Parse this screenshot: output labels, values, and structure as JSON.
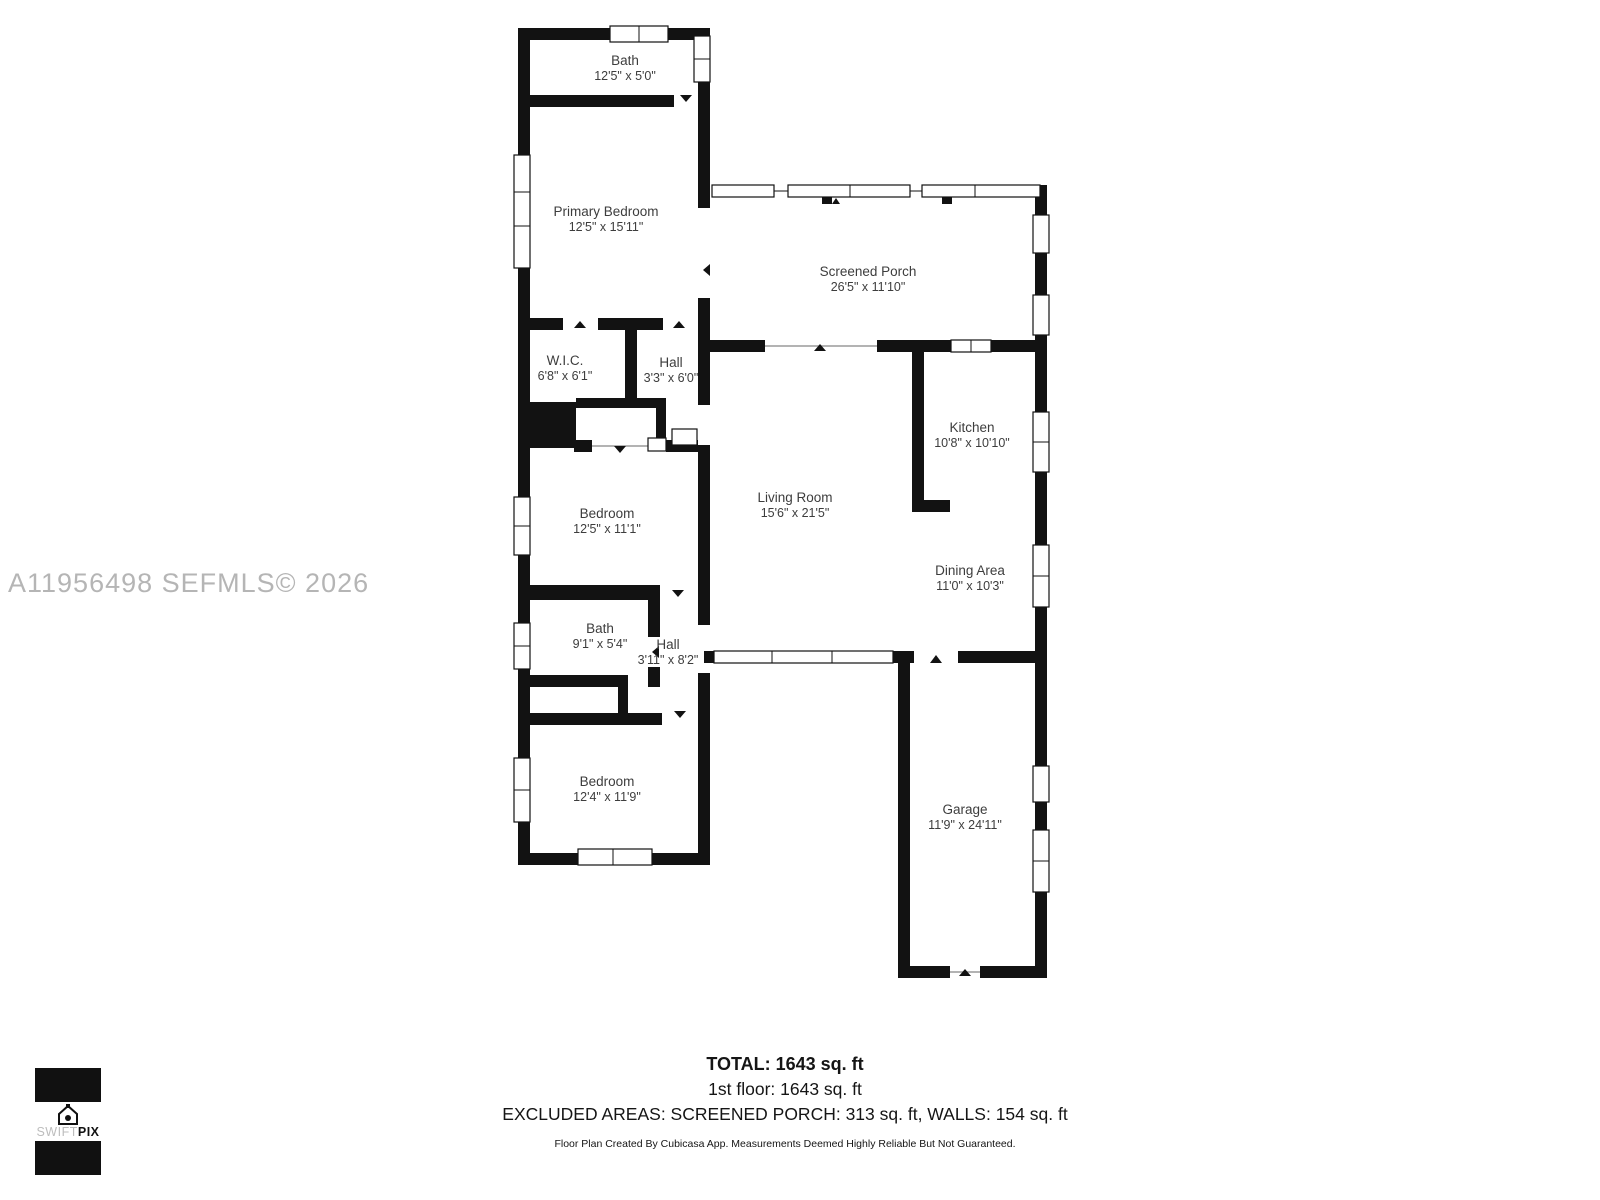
{
  "floor_plan": {
    "rooms": [
      {
        "name": "Bath",
        "dims": "12'5\" x 5'0\""
      },
      {
        "name": "Primary Bedroom",
        "dims": "12'5\" x 15'11\""
      },
      {
        "name": "Screened Porch",
        "dims": "26'5\" x 11'10\""
      },
      {
        "name": "W.I.C.",
        "dims": "6'8\" x 6'1\""
      },
      {
        "name": "Hall",
        "dims": "3'3\" x 6'0\""
      },
      {
        "name": "Kitchen",
        "dims": "10'8\" x 10'10\""
      },
      {
        "name": "Living Room",
        "dims": "15'6\" x 21'5\""
      },
      {
        "name": "Bedroom",
        "dims": "12'5\" x 11'1\""
      },
      {
        "name": "Dining Area",
        "dims": "11'0\" x 10'3\""
      },
      {
        "name": "Bath",
        "dims": "9'1\" x 5'4\""
      },
      {
        "name": "Hall",
        "dims": "3'11\" x 8'2\""
      },
      {
        "name": "Bedroom",
        "dims": "12'4\" x 11'9\""
      },
      {
        "name": "Garage",
        "dims": "11'9\" x 24'11\""
      }
    ]
  },
  "watermark": "A11956498  SEFMLS© 2026",
  "summary": {
    "total": "TOTAL: 1643 sq. ft",
    "first_floor": "1st floor: 1643 sq. ft",
    "excluded": "EXCLUDED AREAS: SCREENED PORCH: 313 sq. ft, WALLS: 154 sq. ft",
    "disclaimer": "Floor Plan Created By Cubicasa App. Measurements Deemed Highly Reliable But Not Guaranteed."
  },
  "logo": {
    "icon": "house-camera-icon",
    "brand_light": "SWIFT",
    "brand_bold": "PIX"
  },
  "colors": {
    "wall": "#121212",
    "room_text": "#3d3d3d",
    "watermark": "#b5b5b5"
  }
}
